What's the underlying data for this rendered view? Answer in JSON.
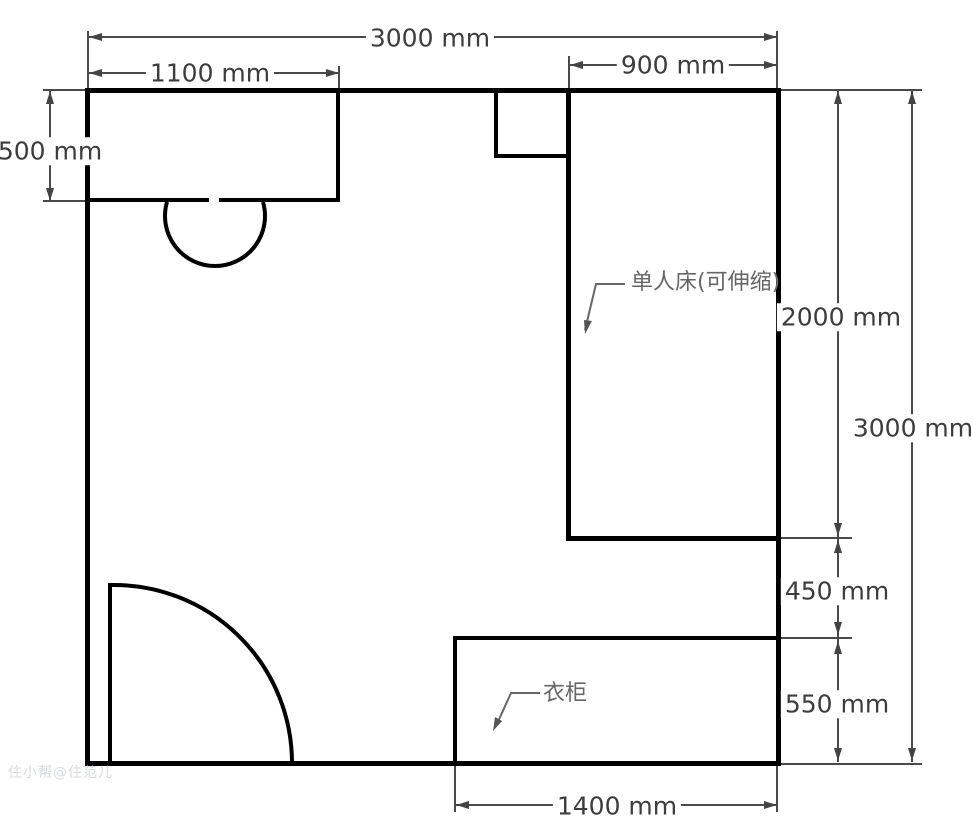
{
  "diagram": {
    "type": "floor-plan",
    "unit": "mm",
    "dimensions": {
      "room_width_top": "3000 mm",
      "desk_width": "1100 mm",
      "bed_width": "900 mm",
      "desk_depth": "500 mm",
      "bed_length": "2000 mm",
      "room_depth_right": "3000 mm",
      "bed_to_wardrobe_gap": "450 mm",
      "wardrobe_depth": "550 mm",
      "wardrobe_width_bottom": "1400 mm"
    },
    "furniture_labels": {
      "bed": "单人床(可伸缩)",
      "wardrobe": "衣柜"
    },
    "watermark": "住小帮@住范儿",
    "colors": {
      "wall": "#000000",
      "dimension_line": "#4a4a4a",
      "dimension_text": "#3d3d3d",
      "label_text": "#666666"
    }
  }
}
